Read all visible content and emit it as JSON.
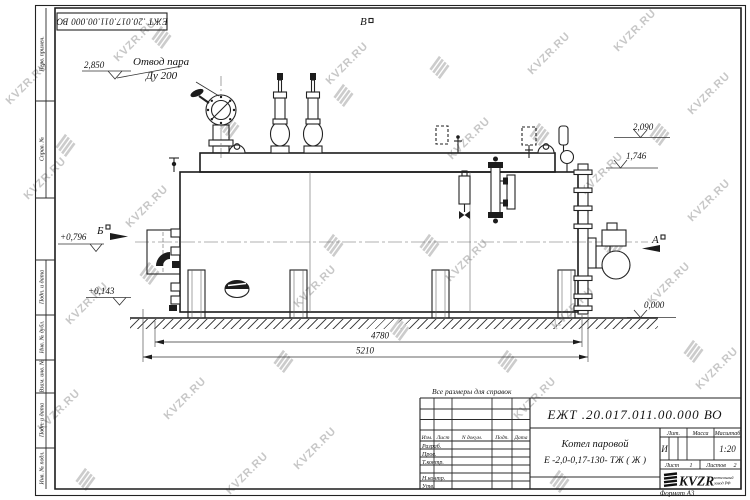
{
  "doc": {
    "code": "ЕЖТ .20.017.011.00.000  ВО",
    "format_note": "Формат А3",
    "reference_note": "Все размеры для справок"
  },
  "title_block": {
    "product_name_line1": "Котел паровой",
    "product_name_line2": "Е -2,0-0,17-130- ТЖ ( Ж )",
    "columns": {
      "izm": "Изм.",
      "list": "Лист",
      "doc": "N докум.",
      "podp": "Подп.",
      "data": "Дата"
    },
    "rows": {
      "razrab": "Разраб.",
      "prov": "Пров.",
      "tkontr": "Т.контр.",
      "nkontr": "Н.контр.",
      "utv": "Утв."
    },
    "lit_label": "Лит.",
    "lit_value": "И",
    "mass_label": "Масса",
    "scale_label": "Масштаб",
    "scale_value": "1:20",
    "sheet_label": "Лист",
    "sheet_value": "1",
    "sheets_label": "Листов",
    "sheets_value": "2",
    "logo_text": "KVZR",
    "logo_sub_line1": "котельный",
    "logo_sub_line2": "завод РФ"
  },
  "side_column": {
    "cells": [
      "Перв. примен.",
      "Справ. №",
      "Подп. и дата",
      "Инв. № дубл.",
      "Взам. инв. №",
      "Подп. и дата",
      "Инв. № подл."
    ]
  },
  "annotations": {
    "steam_outlet_line1": "Отвод пара",
    "steam_outlet_line2": "Ду 200",
    "level_2850": "2,850",
    "level_2090": "2,090",
    "level_1746": "1,746",
    "level_0796": "+0,796",
    "level_0143": "+0,143",
    "level_0000": "0,000",
    "dim_length_4780": "4780",
    "dim_length_5210": "5210",
    "view_b": "Б",
    "view_v": "В",
    "view_a": "А"
  },
  "watermark": {
    "text": "KVZR.RU",
    "color": "#c7c7c7"
  },
  "colors": {
    "line": "#1c1c1c",
    "watermark": "#c7c7c7",
    "background": "#ffffff"
  }
}
